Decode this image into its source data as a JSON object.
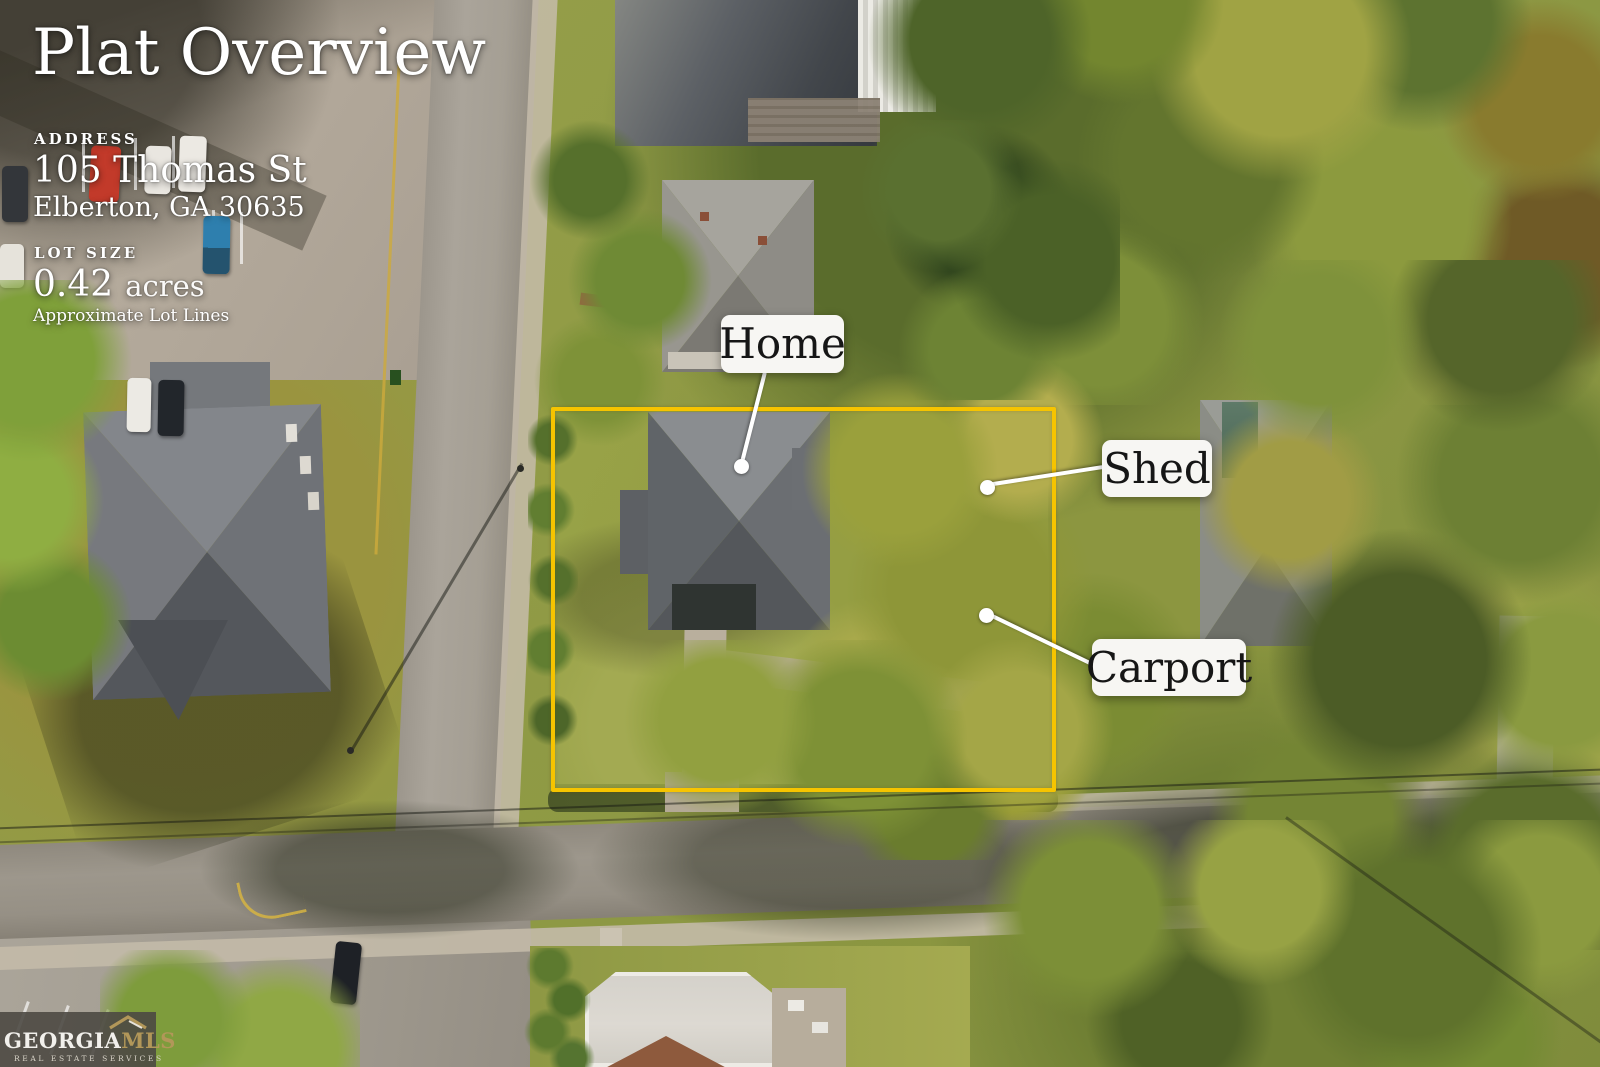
{
  "title": "Plat Overview",
  "address": {
    "heading": "ADDRESS",
    "line1": "105 Thomas St",
    "line2": "Elberton, GA 30635"
  },
  "lot": {
    "heading": "LOT SIZE",
    "value": "0.42",
    "unit": "acres",
    "note": "Approximate Lot Lines"
  },
  "annotations": {
    "home": "Home",
    "shed": "Shed",
    "carport": "Carport"
  },
  "logo": {
    "name": "GEORGIA",
    "suffix": "MLS",
    "tagline": "REAL ESTATE SERVICES"
  },
  "colors": {
    "lot_line": "#f6c400",
    "label_bg": "#f7f6f3",
    "label_text": "#161616",
    "overlay_text": "#ffffff",
    "logo_gold": "#b29759",
    "logo_bg": "#4d4942"
  }
}
